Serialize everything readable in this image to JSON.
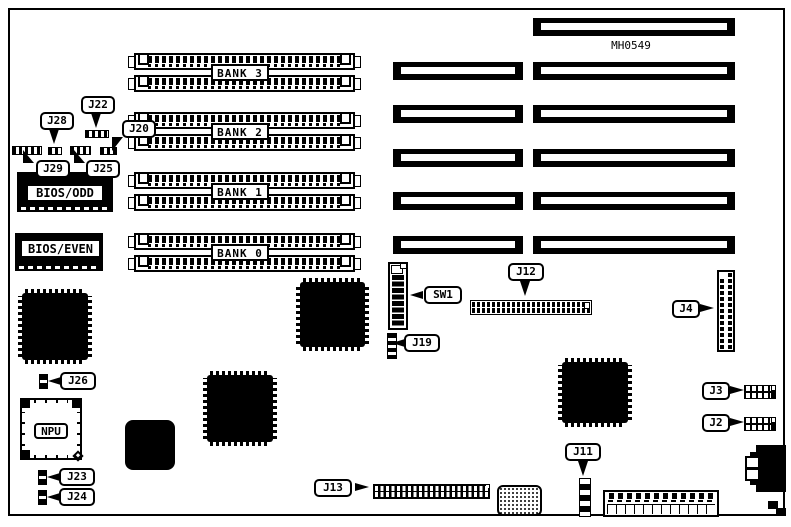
{
  "diagram": {
    "type": "motherboard-component-location-diagram",
    "part_number": "MH0549",
    "colors": {
      "background": "#ffffff",
      "ink": "#000000"
    },
    "memory_banks": [
      {
        "label": "BANK 3"
      },
      {
        "label": "BANK 2"
      },
      {
        "label": "BANK 1"
      },
      {
        "label": "BANK 0"
      }
    ],
    "rom_chips": [
      {
        "label": "BIOS/ODD"
      },
      {
        "label": "BIOS/EVEN"
      }
    ],
    "npu_socket_label": "NPU",
    "callouts": {
      "j28": "J28",
      "j22": "J22",
      "j20": "J20",
      "j29": "J29",
      "j25": "J25",
      "sw1": "SW1",
      "j19": "J19",
      "j12": "J12",
      "j4": "J4",
      "j26": "J26",
      "j23": "J23",
      "j24": "J24",
      "j3": "J3",
      "j2": "J2",
      "j13": "J13",
      "j11": "J11"
    }
  }
}
